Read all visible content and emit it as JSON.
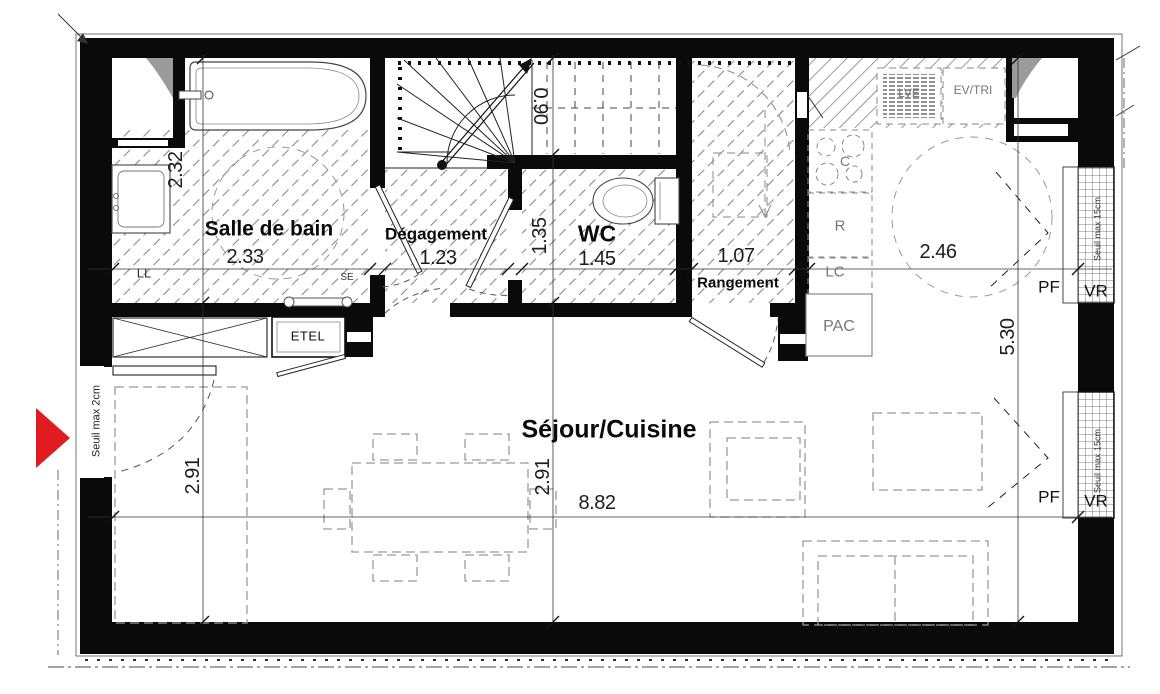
{
  "rooms": {
    "salle_de_bain": {
      "label": "Salle de bain",
      "dim_w": "2.33",
      "dim_h": "2.32"
    },
    "degagement": {
      "label": "Dégagement",
      "dim_w": "1.23"
    },
    "wc": {
      "label": "WC",
      "dim_w": "1.45",
      "dim_h": "1.35"
    },
    "rangement": {
      "label": "Rangement",
      "dim_w": "1.07"
    },
    "sejour_cuisine": {
      "label": "Séjour/Cuisine",
      "dim_w": "8.82",
      "dim_h": "2.91",
      "dim_entry_h": "2.91",
      "dim_kitchen_w": "2.46",
      "dim_kitchen_h": "5.30"
    },
    "escalier": {
      "dim_w": "0.90"
    }
  },
  "equipment": {
    "ll": "LL",
    "se": "SE",
    "etel": "ETEL",
    "lve": "LVE",
    "ev_tri": "EV/TRI",
    "cuisson": "C",
    "refrigerateur": "R",
    "lc": "LC",
    "pac": "PAC"
  },
  "windows": {
    "pf": "PF",
    "vr": "VR",
    "seuil": "Seuil max 15cm"
  },
  "entrance": {
    "seuil": "Seuil max 2cm"
  },
  "colors": {
    "entrance_arrow": "#e11b22",
    "wall": "#0a0a0a",
    "hatch": "#8a8a8a",
    "furniture": "#9a9a9a",
    "equipment_label": "#777777"
  }
}
